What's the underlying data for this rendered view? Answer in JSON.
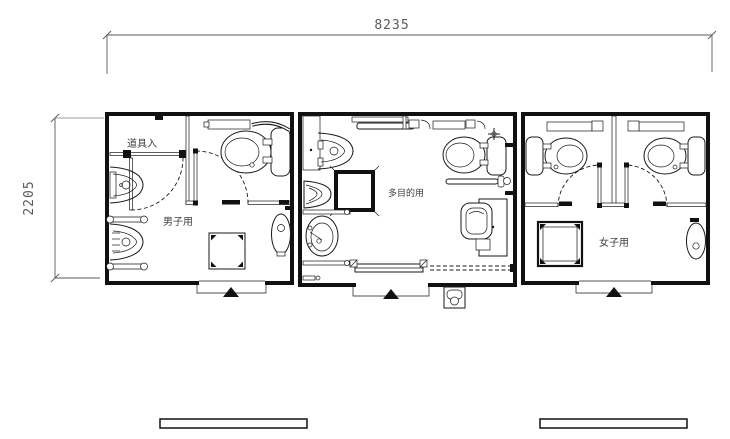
{
  "plan": {
    "dim_width": "8235",
    "dim_depth": "2205",
    "mens_label": "男子用",
    "mens_closet_label": "道具入",
    "multi_label": "多目的用",
    "womens_label": "女子用"
  },
  "colors": {
    "line": "#1a1a1a",
    "background": "#ffffff",
    "dimension_text": "#5a5a5a"
  }
}
